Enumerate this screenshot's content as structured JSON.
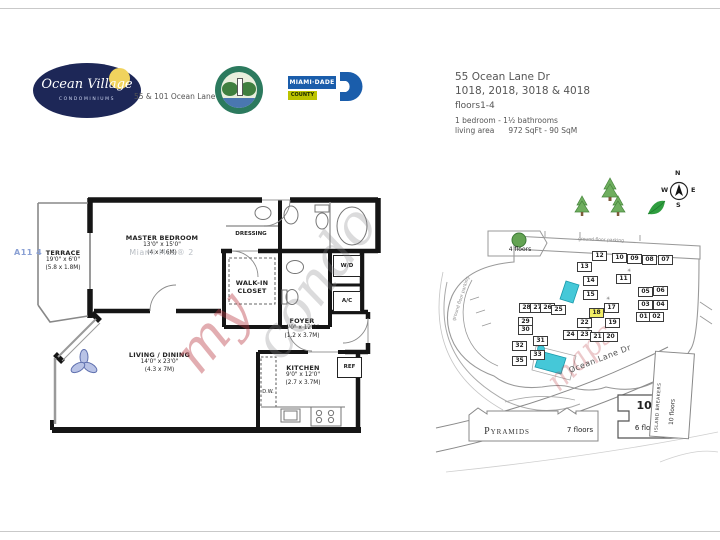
{
  "header": {
    "ocean_village": {
      "title": "Ocean Village",
      "subtitle": "CONDOMINIUMS"
    },
    "address_caption": "55 & 101 Ocean Lane Dr",
    "miami_dade": {
      "line1": "MIAMI·DADE",
      "line2": "COUNTY"
    },
    "listing": {
      "address": "55 Ocean Lane Dr",
      "units": "1018, 2018, 3018 & 4018",
      "floors": "floors1-4",
      "bed_bath": "1 bedroom - 1½ bathrooms",
      "living_area_label": "living area",
      "living_area_value": "972 SqFt - 90 SqM"
    }
  },
  "floorplan": {
    "rooms": {
      "terrace": {
        "name": "TERRACE",
        "dim_ft": "19'0\" x 6'0\"",
        "dim_m": "(5.8 x 1.8M)"
      },
      "master": {
        "name": "MASTER BEDROOM",
        "dim_ft": "13'0\" x 15'0\"",
        "dim_m": "(4 x 4.6M)"
      },
      "dressing": {
        "name": "DRESSING"
      },
      "walkin_line1": "WALK-IN",
      "walkin_line2": "CLOSET",
      "foyer": {
        "name": "FOYER",
        "dim_ft": "4'0\" x 12'0\"",
        "dim_m": "(1.2 x 3.7M)"
      },
      "kitchen": {
        "name": "KITCHEN",
        "dim_ft": "9'0\" x 12'0\"",
        "dim_m": "(2.7 x 3.7M)"
      },
      "living": {
        "name": "LIVING / DINING",
        "dim_ft": "14'0\" x 23'0\"",
        "dim_m": "(4.3 x 7M)"
      }
    },
    "fixtures": {
      "wd": "W/D",
      "ac": "A/C",
      "ref": "REF",
      "dw": "D.W."
    }
  },
  "watermarks": {
    "mls_a": "A11 4",
    "mls_b": "Miami MLS®  2",
    "script_gray": "condo",
    "script_red": "my",
    "script_red2": "maps"
  },
  "sitemap": {
    "compass": {
      "n": "N",
      "w": "W",
      "e": "E",
      "s": "S"
    },
    "labels": {
      "four_floors": "4 floors",
      "ground_parking_top": "ground floor parking",
      "ground_parking_left": "ground floor parking",
      "street": "Ocean Lane Dr",
      "bld100_number": "100",
      "bld100_floors": "6 floors",
      "island_breakers": "ISLAND BREAKERS",
      "island_breakers_floors": "10 floors",
      "pyramids": "Pyramids",
      "pyramids_floors": "7 floors"
    },
    "highlight_color": "#f2ee66",
    "pool_color": "#45c8d8",
    "units": [
      {
        "label": "12",
        "x": 592,
        "y": 251
      },
      {
        "label": "10",
        "x": 612,
        "y": 253
      },
      {
        "label": "09",
        "x": 627,
        "y": 254
      },
      {
        "label": "08",
        "x": 642,
        "y": 255
      },
      {
        "label": "07",
        "x": 658,
        "y": 255
      },
      {
        "label": "13",
        "x": 577,
        "y": 262
      },
      {
        "label": "14",
        "x": 583,
        "y": 276
      },
      {
        "label": "11",
        "x": 616,
        "y": 274
      },
      {
        "label": "15",
        "x": 583,
        "y": 290
      },
      {
        "label": "05",
        "x": 638,
        "y": 287
      },
      {
        "label": "06",
        "x": 653,
        "y": 286
      },
      {
        "label": "03",
        "x": 638,
        "y": 300
      },
      {
        "label": "04",
        "x": 653,
        "y": 300
      },
      {
        "label": "17",
        "x": 604,
        "y": 303
      },
      {
        "label": "18",
        "x": 589,
        "y": 308,
        "hl": true
      },
      {
        "label": "01",
        "x": 636,
        "y": 312
      },
      {
        "label": "02",
        "x": 649,
        "y": 312
      },
      {
        "label": "28",
        "x": 519,
        "y": 303
      },
      {
        "label": "27",
        "x": 530,
        "y": 303
      },
      {
        "label": "26",
        "x": 540,
        "y": 303
      },
      {
        "label": "25",
        "x": 551,
        "y": 305
      },
      {
        "label": "29",
        "x": 518,
        "y": 317
      },
      {
        "label": "30",
        "x": 518,
        "y": 325
      },
      {
        "label": "22",
        "x": 577,
        "y": 318
      },
      {
        "label": "19",
        "x": 605,
        "y": 318
      },
      {
        "label": "31",
        "x": 533,
        "y": 336
      },
      {
        "label": "32",
        "x": 512,
        "y": 341
      },
      {
        "label": "24",
        "x": 563,
        "y": 330
      },
      {
        "label": "23",
        "x": 577,
        "y": 330
      },
      {
        "label": "21",
        "x": 590,
        "y": 332
      },
      {
        "label": "20",
        "x": 603,
        "y": 332
      },
      {
        "label": "33",
        "x": 530,
        "y": 350
      },
      {
        "label": "35",
        "x": 512,
        "y": 356
      }
    ]
  }
}
